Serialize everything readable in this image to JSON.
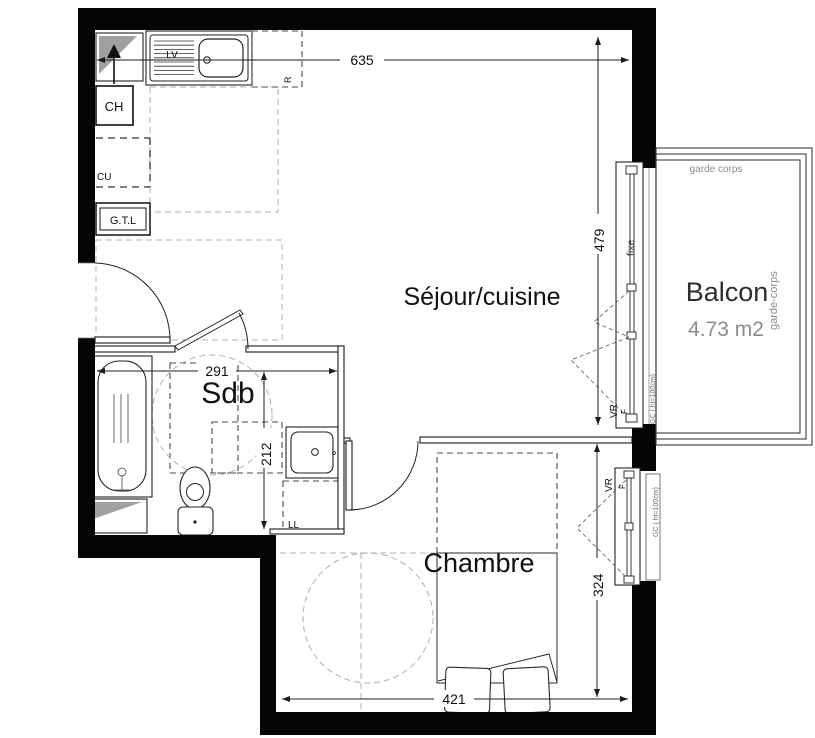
{
  "plan": {
    "rooms": {
      "sejour": "Séjour/cuisine",
      "sdb": "Sdb",
      "chambre": "Chambre",
      "balcon": "Balcon",
      "balcon_area": "4.73 m2"
    },
    "dims": {
      "top": "635",
      "sejour_h": "479",
      "sdb_w": "291",
      "sdb_h": "212",
      "chambre_h": "324",
      "chambre_w": "421"
    },
    "labels": {
      "ch": "CH",
      "cu": "CU",
      "gtl": "G.T.L",
      "lv": "LV",
      "fridge": "R",
      "ll": "LL",
      "fixe": "fixe",
      "vr": "VR",
      "f": "F",
      "gc_note": "GC ( ht=100cm)",
      "garde_corps_top": "garde corps",
      "garde_corps_right": "garde-corps"
    },
    "colors": {
      "wall": "#050505",
      "line": "#1c1c1c",
      "dash_dark": "#4a4a4a",
      "dash_light": "#b0b0b0",
      "gray_text": "#8c8c8c",
      "balcon_text": "#2e2e2e"
    }
  }
}
